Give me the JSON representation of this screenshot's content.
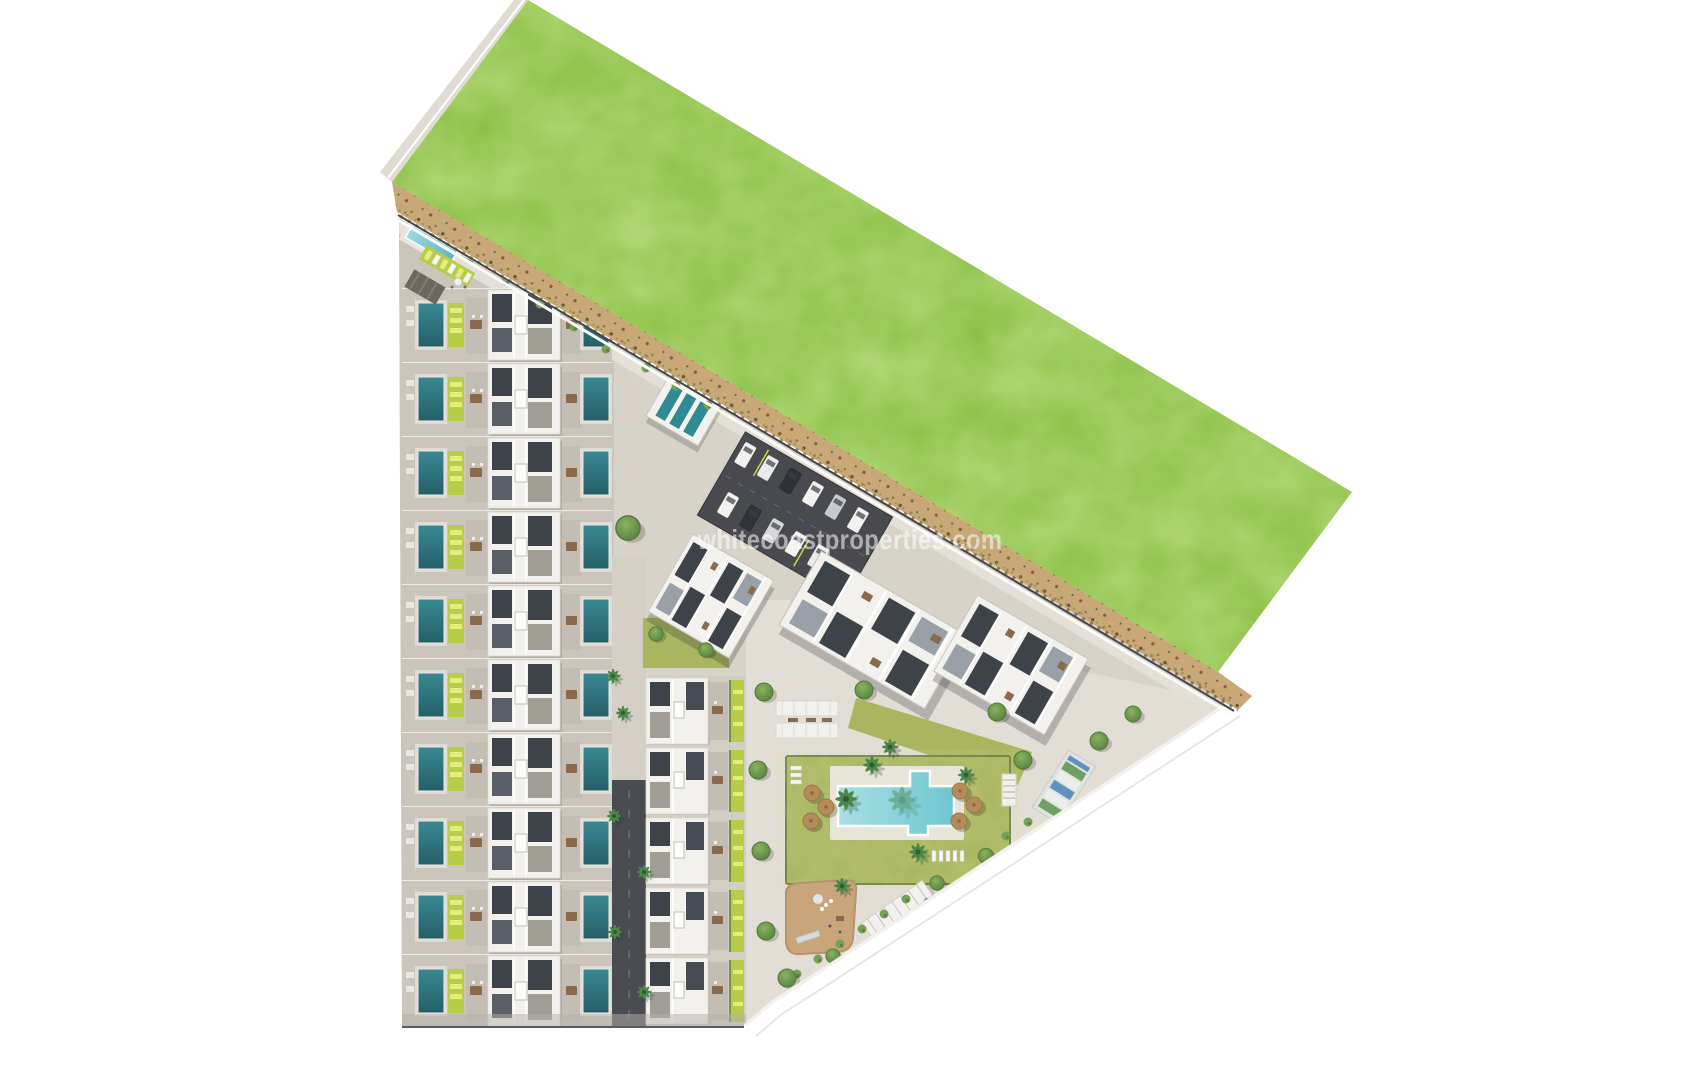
{
  "watermark": {
    "text": "whitecoastproperties.com",
    "color": "#ffffff",
    "opacity": 0.55
  },
  "scene": {
    "kind": "aerial-3d-masterplan-render",
    "site_label": "coastal residential development",
    "counts": {
      "townhouse_rows_west": 10,
      "townhouse_rows_center": 5,
      "apartment_blocks": 3,
      "parked_cars": 11,
      "pool_umbrellas": 6,
      "garden_palm_trees": 6,
      "road_palm_trees": 6,
      "round_trees": 16,
      "pergolas": 4,
      "playgrounds": 1,
      "padel_courts": 1,
      "communal_pools": 2,
      "private_pools_per_row": 2
    },
    "palette": {
      "background": "#ffffff",
      "grass": "#8cc047",
      "grass_light": "#9ed254",
      "sand": "#c9a877",
      "pavement": "#d8d3c9",
      "pavement_light": "#e2ded6",
      "strip_ground": "#cbc5bb",
      "asphalt": "#4b4b52",
      "building_white": "#f2f1ee",
      "roof_dark": "#3e434a",
      "roof_gray": "#a09d94",
      "terrace_gray": "#c3bdb3",
      "pool_teal": "#3a8893",
      "pool_cyan": "#6ec6d0",
      "lawn": "#a9b65f",
      "garden_lime": "#b7cd49",
      "lounger_lime": "#e3ec7d",
      "umbrella_tan": "#b48c5c",
      "playground_tan": "#c9a57b",
      "tree_green": "#6f9c4c",
      "furniture_brown": "#8a6a4c"
    }
  }
}
